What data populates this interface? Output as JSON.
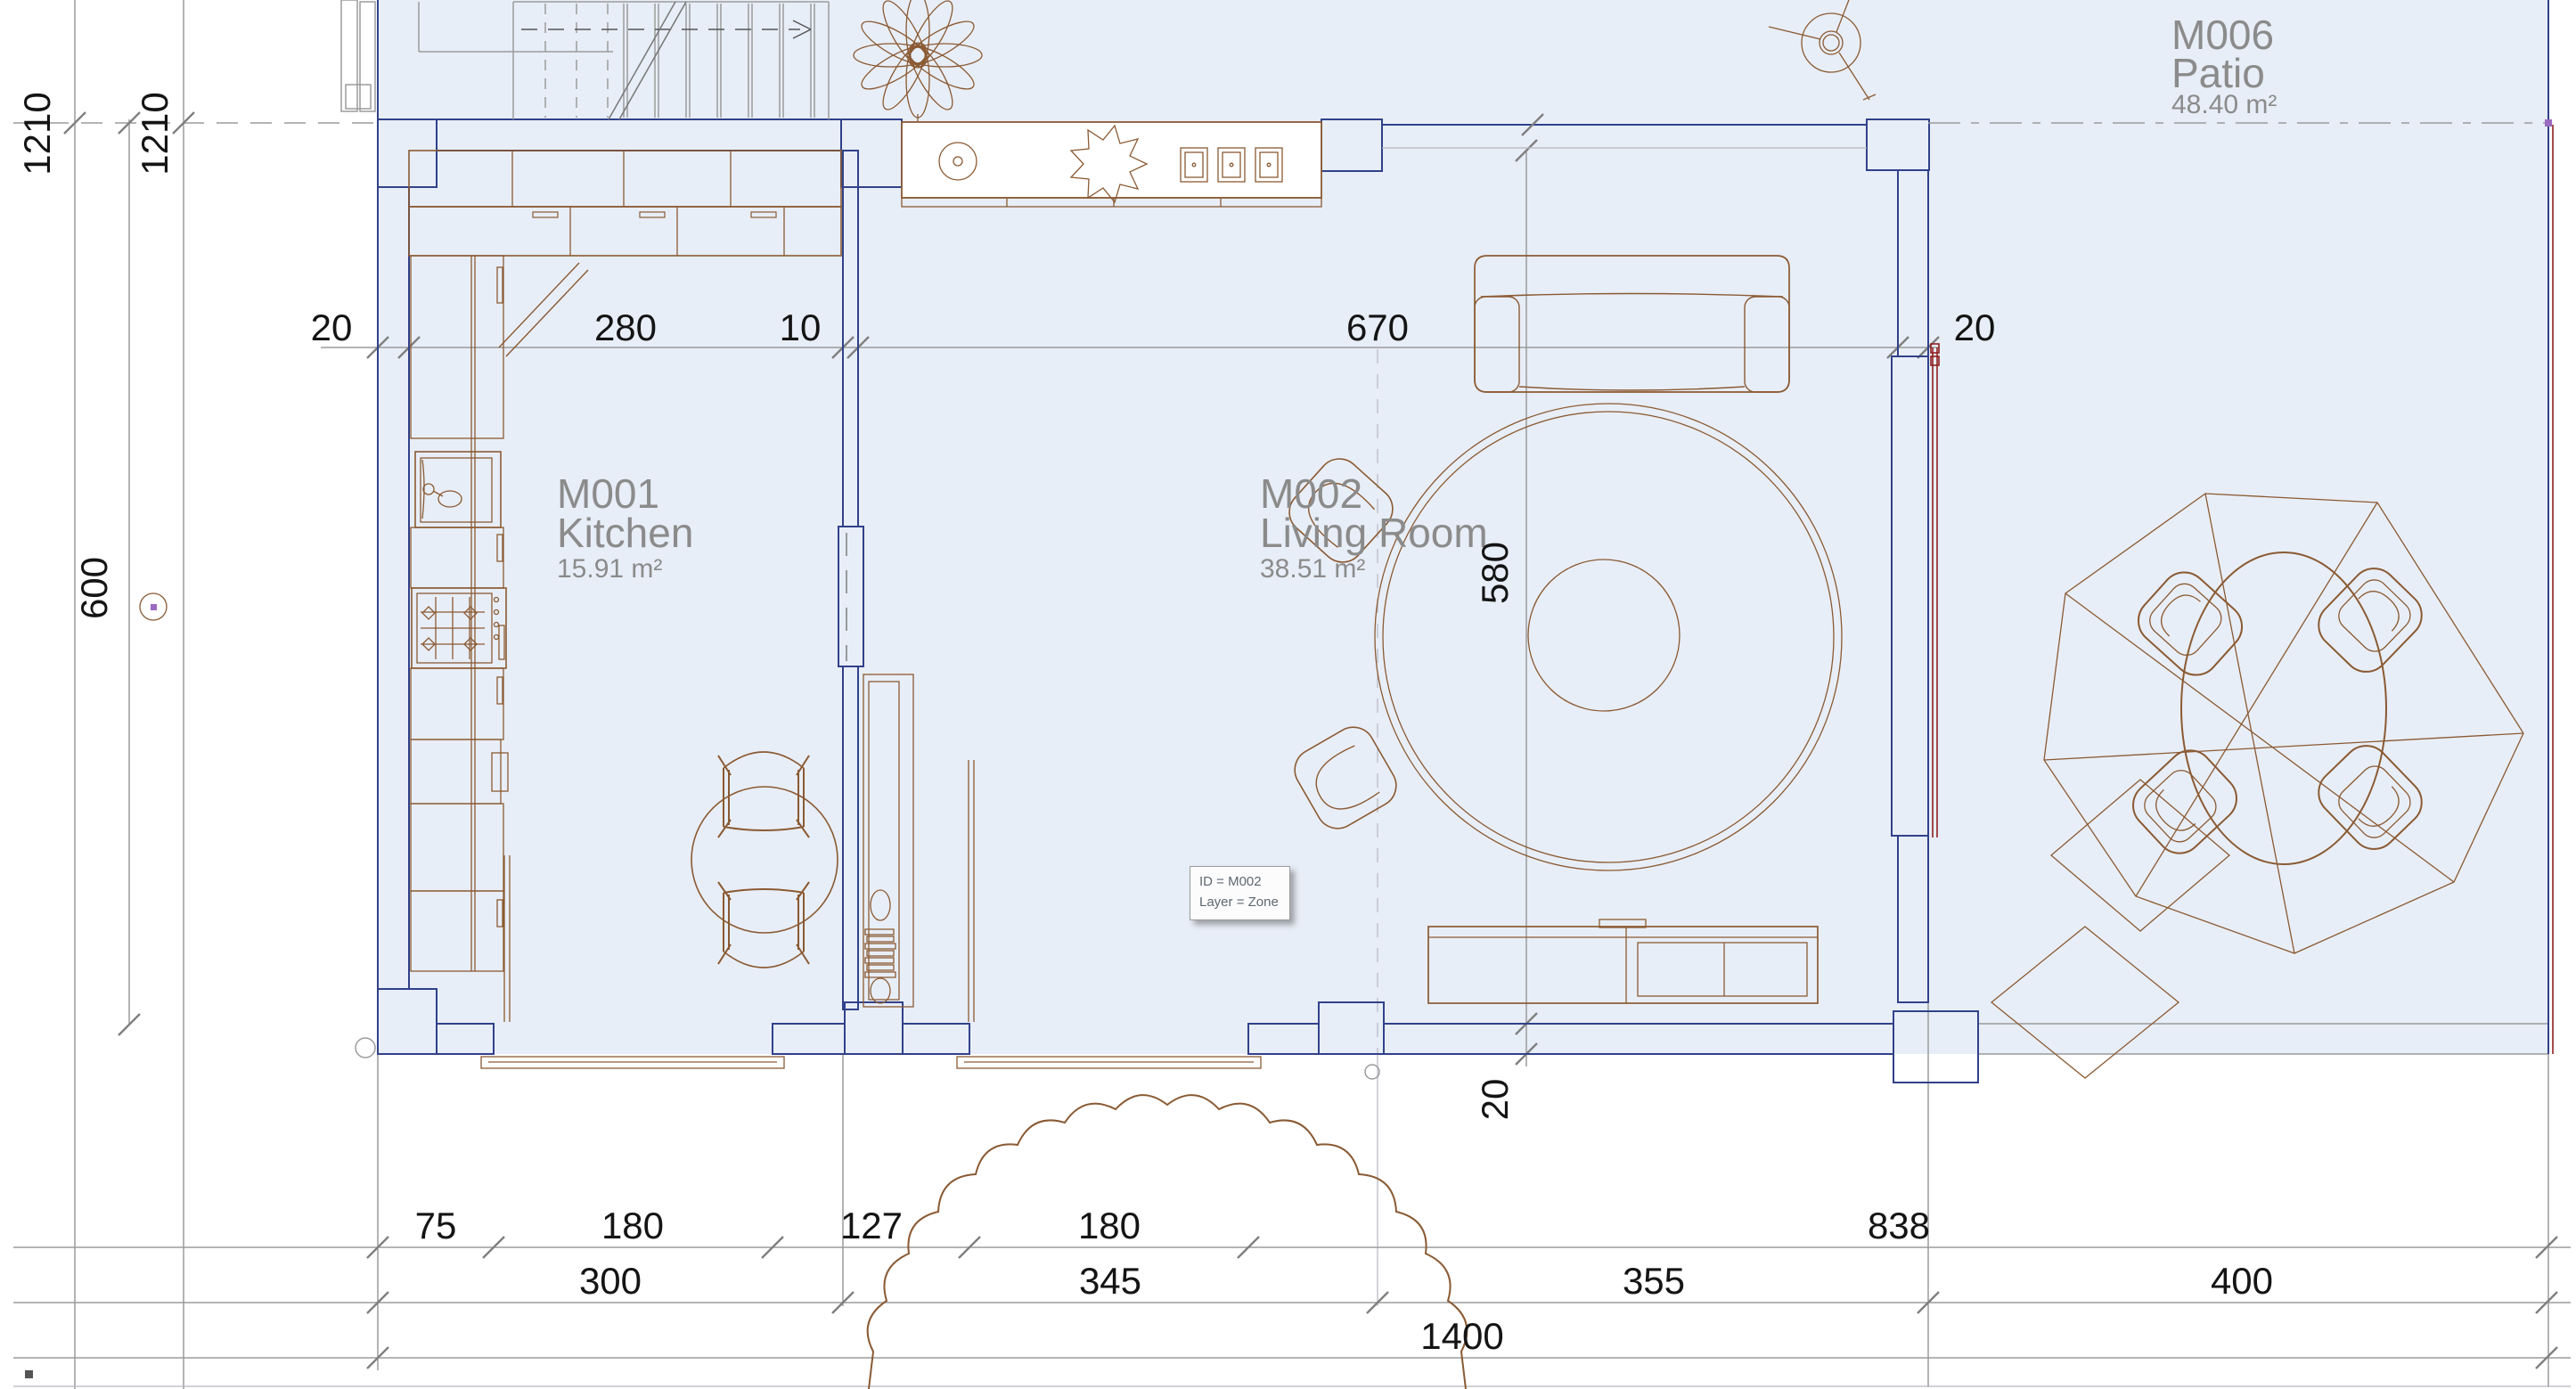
{
  "rooms": [
    {
      "id": "M001",
      "name": "Kitchen",
      "area": "15.91 m²"
    },
    {
      "id": "M002",
      "name": "Living Room",
      "area": "38.51 m²"
    },
    {
      "id": "M006",
      "name": "Patio",
      "area": "48.40 m²"
    }
  ],
  "dimensions": {
    "top": [
      "20",
      "280",
      "10",
      "670",
      "20"
    ],
    "left_vertical": [
      "1210",
      "1210",
      "600"
    ],
    "interior_height": "580",
    "bottom_wall_thickness": "20",
    "bottom_row1": [
      "75",
      "180",
      "127",
      "180",
      "838"
    ],
    "bottom_row2": [
      "300",
      "345",
      "355",
      "400"
    ],
    "bottom_total": "1400"
  },
  "tooltip": {
    "line1": "ID = M002",
    "line2": "Layer = Zone"
  },
  "colors": {
    "floor_fill": "#e8eef7",
    "wall_hatch_bg": "#e7e9f2",
    "wall_edge_navy": "#31418a",
    "pillar_purple": "#9d9ecb",
    "furniture_brown": "#8a5a33",
    "annotation_gray": "#9b9b9b",
    "dimension_text": "#141414",
    "room_label_gray": "#8b8b8b",
    "accent_red": "#8f2020"
  }
}
